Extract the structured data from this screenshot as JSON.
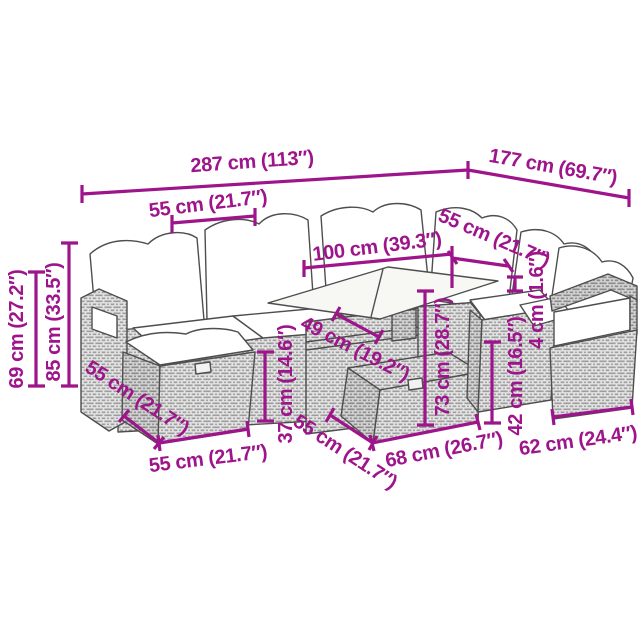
{
  "accent_color": "#9e148b",
  "drawing_color": "#4e4e4e",
  "figure": {
    "description": "Line drawing of a poly rattan garden lounge set: corner sofa with back cushions, armchair, two footstool ottomans and a glass-top table"
  },
  "dimensions": [
    {
      "id": "total-width",
      "text": "287 cm (113″)"
    },
    {
      "id": "total-depth",
      "text": "177 cm (69.7″)"
    },
    {
      "id": "seat-width-top",
      "text": "55 cm (21.7″)"
    },
    {
      "id": "table-length",
      "text": "100 cm (39.3″)"
    },
    {
      "id": "seat-width-right",
      "text": "55 cm (21.7″)"
    },
    {
      "id": "cushion-thickness",
      "text": "4 cm (1.6″)"
    },
    {
      "id": "armrest-height",
      "text": "69 cm (27.2″)"
    },
    {
      "id": "back-height",
      "text": "85 cm (33.5″)"
    },
    {
      "id": "ottoman-depth-left",
      "text": "55 cm (21.7″)"
    },
    {
      "id": "ottoman-width-left",
      "text": "55 cm (21.7″)"
    },
    {
      "id": "ottoman-height",
      "text": "37 cm (14.6″)"
    },
    {
      "id": "table-width",
      "text": "49 cm (19.2″)"
    },
    {
      "id": "table-height",
      "text": "73 cm (28.7″)"
    },
    {
      "id": "seat-depth-mid",
      "text": "55 cm (21.7″)"
    },
    {
      "id": "base-width-mid",
      "text": "68 cm (26.7″)"
    },
    {
      "id": "seat-height",
      "text": "42 cm (16.5″)"
    },
    {
      "id": "armchair-width",
      "text": "62 cm (24.4″)"
    }
  ]
}
